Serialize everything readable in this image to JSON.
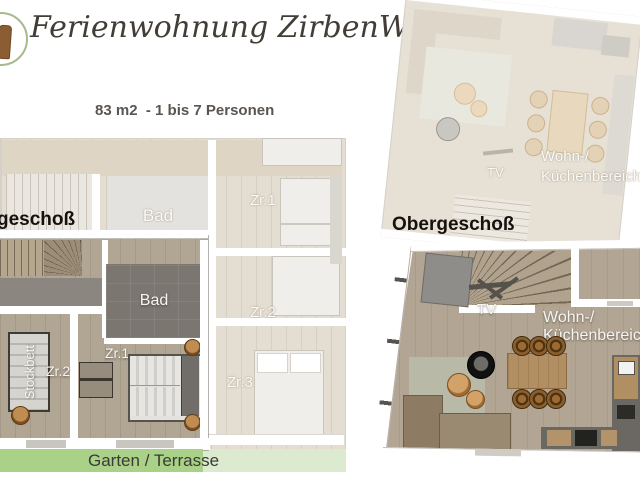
{
  "header": {
    "logo": "zirbenwald-logo",
    "title": "Ferienwohnung ZirbenWald",
    "subtitle_lines": [
      "83 m2  - 1 bis 7 Personen",
      "Sonnenterrasse",
      "Gartenbereich"
    ]
  },
  "ground_floor": {
    "label_partial": "geschoß",
    "terrace_label": "Garten / Terrasse",
    "vivid_rooms": {
      "bad": "Bad",
      "zr1": "Zr.1",
      "zr2": "Zr.2",
      "stockbett": "Stockbett"
    },
    "faded_rooms": {
      "bad": "Bad",
      "zr1": "Zr.1",
      "zr2": "Zr.2",
      "zr3": "Zr.3"
    }
  },
  "upper_floor": {
    "label": "Obergeschoß",
    "vivid_rooms": {
      "tv": "TV",
      "wohn": "Wohn-/",
      "kueche": "Küchenbereich"
    },
    "faded_rooms": {
      "tv": "TV",
      "wohn": "Wohn-/",
      "kueche": "Küchenbereich"
    }
  },
  "colors": {
    "terrace_green": "#a9d188",
    "terrace_green_faded": "#dcead0",
    "floor_wood": "#b1a593",
    "logo_green": "#a6ba8e",
    "logo_brown": "#8a5d33",
    "title_text": "#423d36"
  }
}
